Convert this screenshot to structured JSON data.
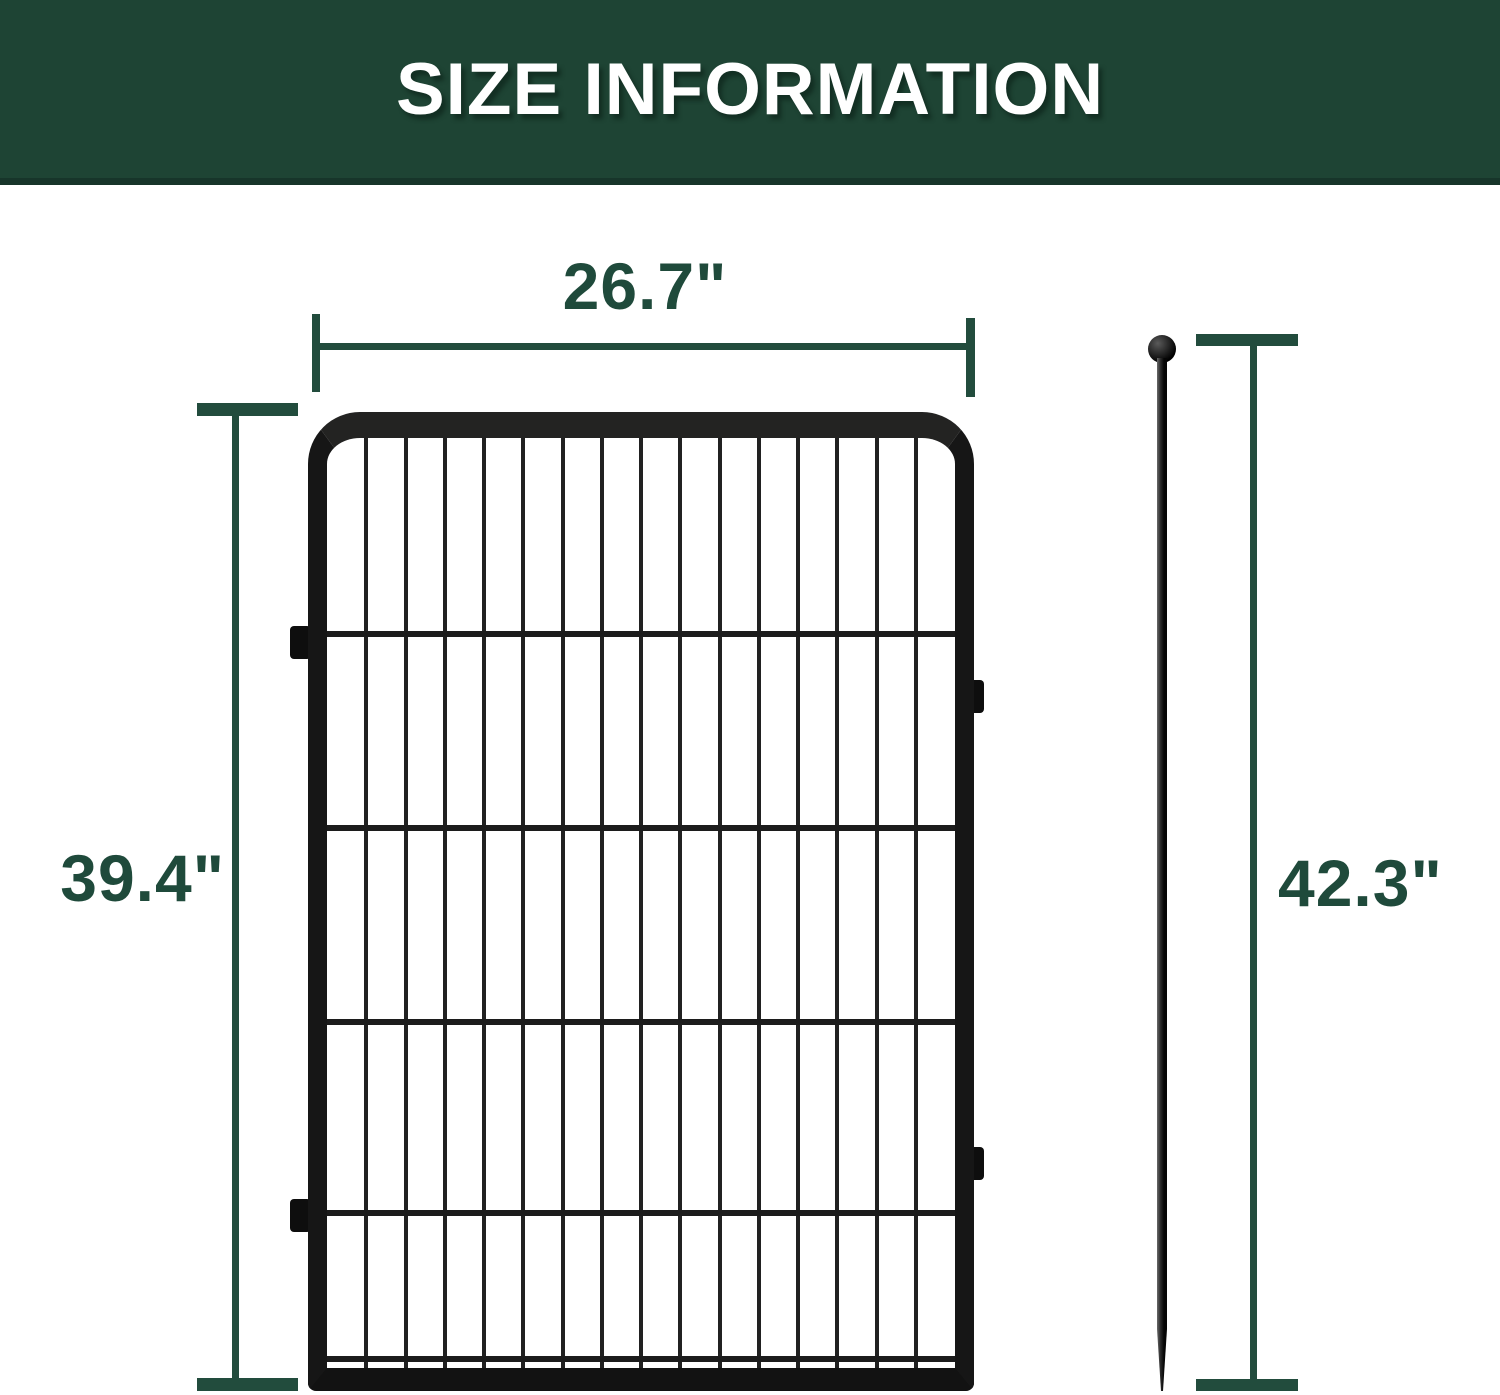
{
  "header": {
    "title": "SIZE INFORMATION",
    "bg_color": "#1e4434",
    "text_color": "#ffffff"
  },
  "dimensions": {
    "width_label": "26.7\"",
    "height_label": "39.4\"",
    "stake_height_label": "42.3\"",
    "line_color": "#224c3d",
    "label_color": "#1f4a3b"
  },
  "fence": {
    "color": "#1a1a1a",
    "vertical_bars": 15,
    "horizontal_rails": 4,
    "side_connector_tabs": 4
  },
  "stake": {
    "color": "#141414",
    "top": "ball",
    "bottom": "pointed-tip"
  }
}
